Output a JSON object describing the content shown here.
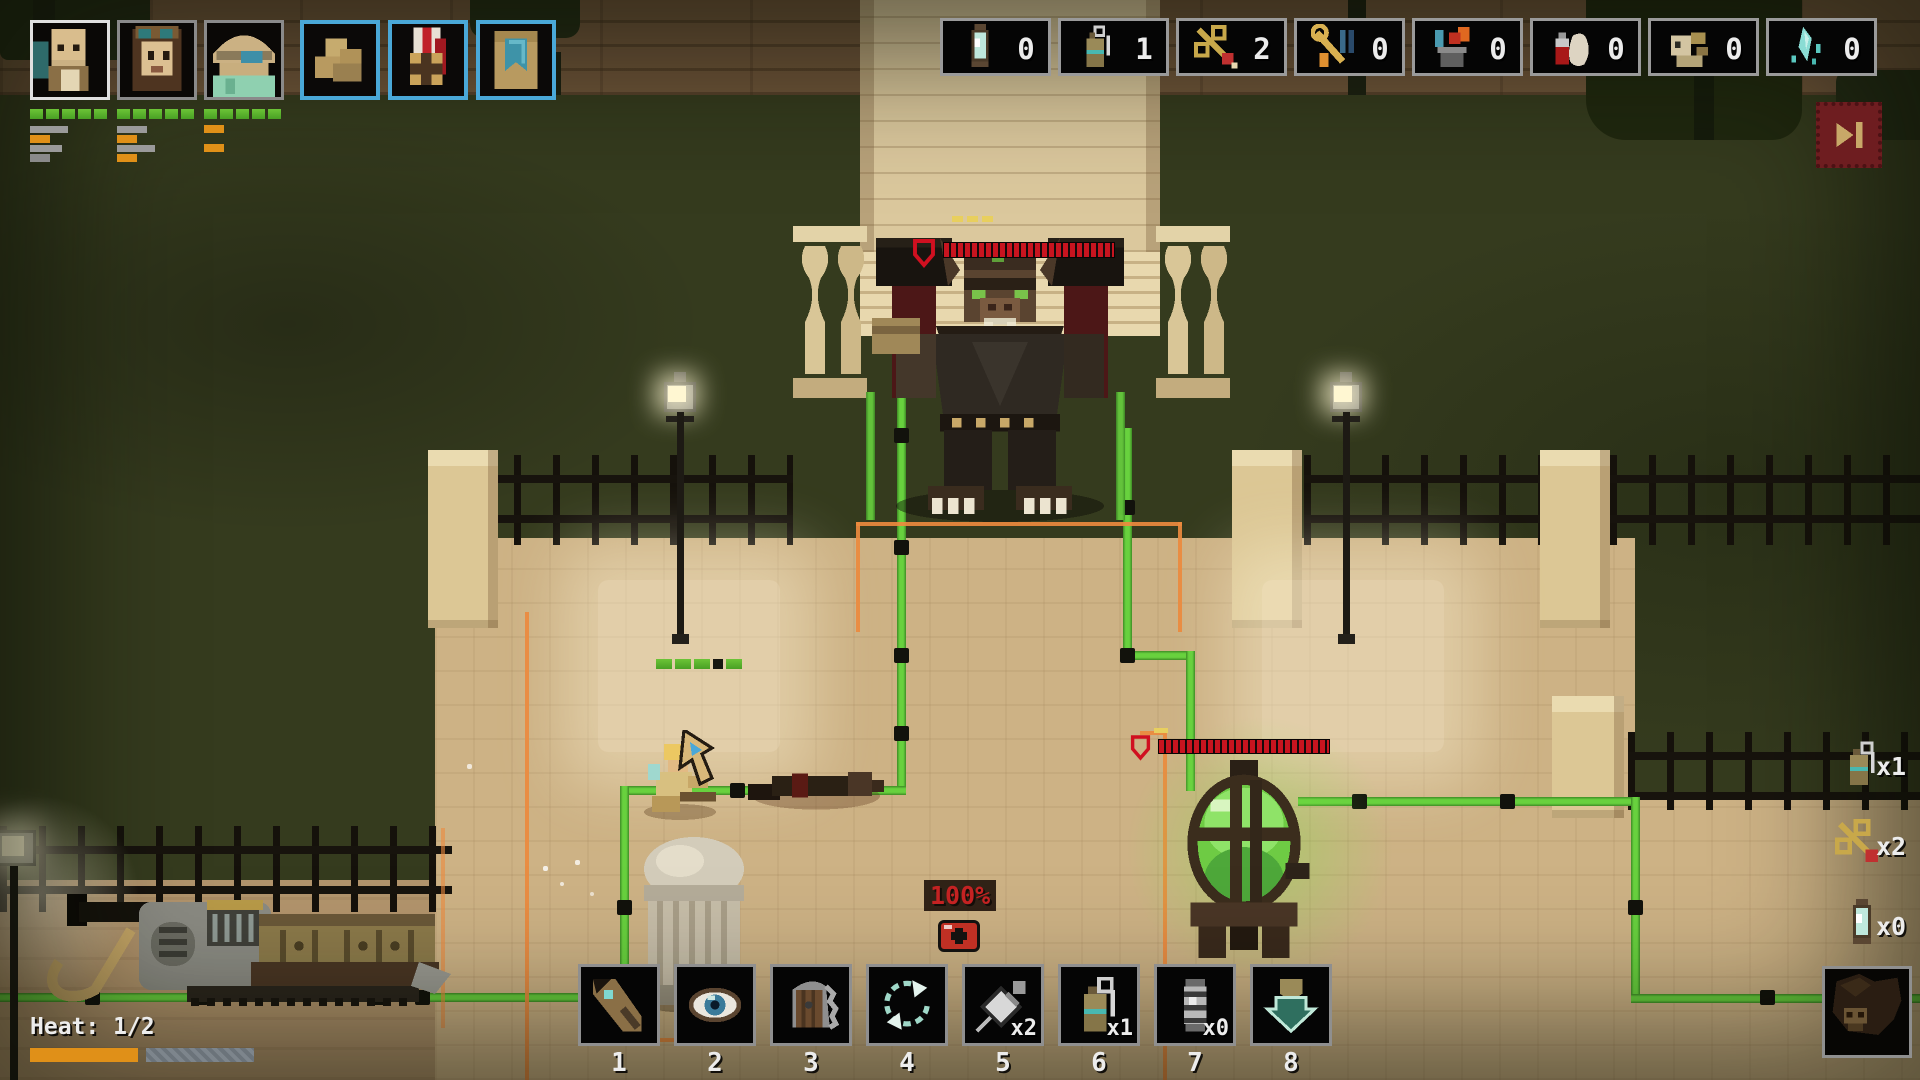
{
  "hud": {
    "party": {
      "members": [
        {
          "name": "bearded-soldier",
          "selected": true
        },
        {
          "name": "goggles-scout",
          "selected": false
        },
        {
          "name": "hat-engineer",
          "selected": false
        }
      ],
      "items": [
        {
          "icon": "rock-pile-icon"
        },
        {
          "icon": "medal-icon"
        },
        {
          "icon": "banner-book-icon"
        }
      ]
    },
    "resources": {
      "slots": [
        {
          "icon": "lantern",
          "count": "0"
        },
        {
          "icon": "grenade",
          "count": "1"
        },
        {
          "icon": "dart",
          "count": "2"
        },
        {
          "icon": "tools",
          "count": "0"
        },
        {
          "icon": "cooking",
          "count": "0"
        },
        {
          "icon": "medicine",
          "count": "0"
        },
        {
          "icon": "bones",
          "count": "0"
        },
        {
          "icon": "crystal",
          "count": "0"
        }
      ]
    },
    "skip_button": {
      "icon": "skip-forward"
    },
    "hit_chance": "100%",
    "heat": {
      "label": "Heat: 1/2",
      "fill_pct": 48
    },
    "hotbar": {
      "slots": [
        {
          "key": "1",
          "icon": "scope-gun",
          "count": ""
        },
        {
          "key": "2",
          "icon": "overwatch-eye",
          "count": ""
        },
        {
          "key": "3",
          "icon": "armored-door",
          "count": ""
        },
        {
          "key": "4",
          "icon": "cycle-arrows",
          "count": ""
        },
        {
          "key": "5",
          "icon": "syringe",
          "count": "x2"
        },
        {
          "key": "6",
          "icon": "grenade",
          "count": "x1"
        },
        {
          "key": "7",
          "icon": "stun-canister",
          "count": "x0"
        },
        {
          "key": "8",
          "icon": "descend-arrow",
          "count": ""
        }
      ]
    },
    "quick_items": [
      {
        "icon": "grenade",
        "count": "x1"
      },
      {
        "icon": "dart",
        "count": "x2"
      },
      {
        "icon": "lantern",
        "count": "x0"
      }
    ],
    "enemy_portrait": {
      "icon": "beast-face"
    }
  },
  "world": {
    "boss_health_segments": 24,
    "boss_armor_pips": 3,
    "lantern_health_segments": 26,
    "lamp_health_segments": 5
  },
  "colors": {
    "cable_green": "#68d13e",
    "path_orange": "#ec8a3e",
    "health_red": "#c8141f",
    "hp_green": "#6cc437",
    "heat_orange": "#e09018",
    "slot_blue_border": "#4aa8d8",
    "skip_red": "#6e1d20"
  }
}
